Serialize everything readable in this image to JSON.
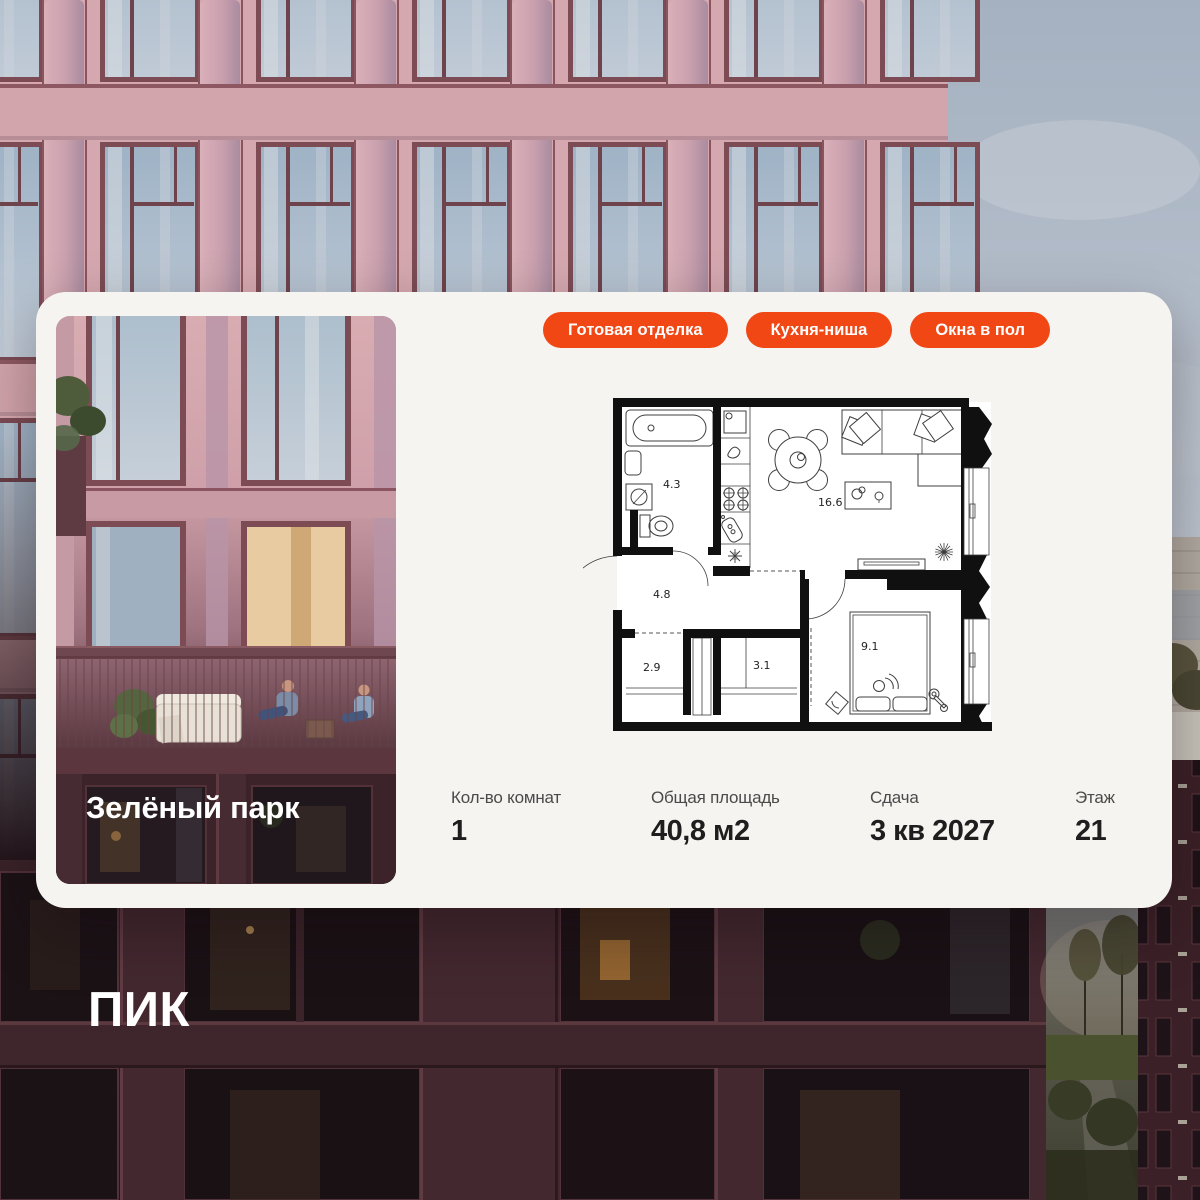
{
  "brand": {
    "logo": "ПИК"
  },
  "card": {
    "project_name": "Зелёный парк",
    "tags": [
      "Готовая отделка",
      "Кухня-ниша",
      "Окна в пол"
    ],
    "floorplan": {
      "areas": {
        "bathroom": "4.3",
        "kitchen_living": "16.6",
        "hallway": "4.8",
        "wardrobe": "2.9",
        "storage": "3.1",
        "bedroom": "9.1"
      }
    },
    "stats": [
      {
        "label": "Кол-во комнат",
        "value": "1"
      },
      {
        "label": "Общая площадь",
        "value": "40,8 м2"
      },
      {
        "label": "Сдача",
        "value": "3 кв 2027"
      },
      {
        "label": "Этаж",
        "value": "21"
      }
    ]
  },
  "colors": {
    "accent": "#F04715",
    "card_bg": "#F5F4F0",
    "text_dark": "#1E1E1E",
    "text_gray": "#4A4A4A"
  }
}
